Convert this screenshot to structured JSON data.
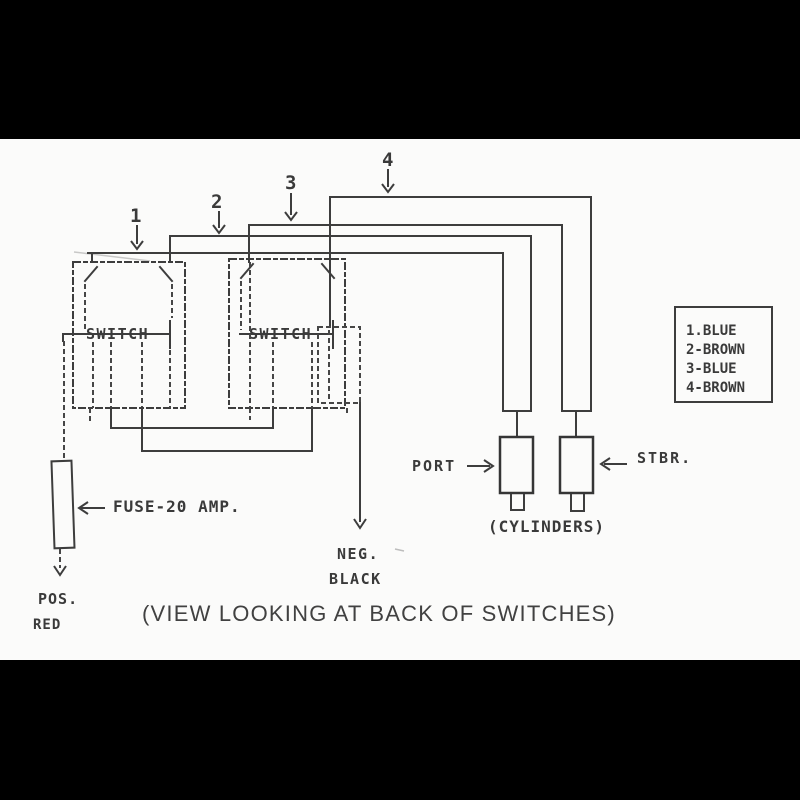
{
  "colors": {
    "bar": "#000000",
    "paper": "#fbfbfa",
    "ink": "#3d3d3d"
  },
  "diagram": {
    "wires": [
      "1",
      "2",
      "3",
      "4"
    ],
    "switch1_label": "SWITCH",
    "switch2_label": "SWITCH",
    "fuse_label": "FUSE-20 AMP.",
    "pos_label": "POS.",
    "red_label": "RED",
    "neg_label": "NEG.",
    "black_label": "BLACK",
    "port_label": "PORT",
    "stbr_label": "STBR.",
    "cylinders_label": "(CYLINDERS)",
    "caption": "(VIEW LOOKING AT BACK OF SWITCHES)",
    "legend": {
      "items": [
        "1.BLUE",
        "2-BROWN",
        "3-BLUE",
        "4-BROWN"
      ]
    }
  }
}
